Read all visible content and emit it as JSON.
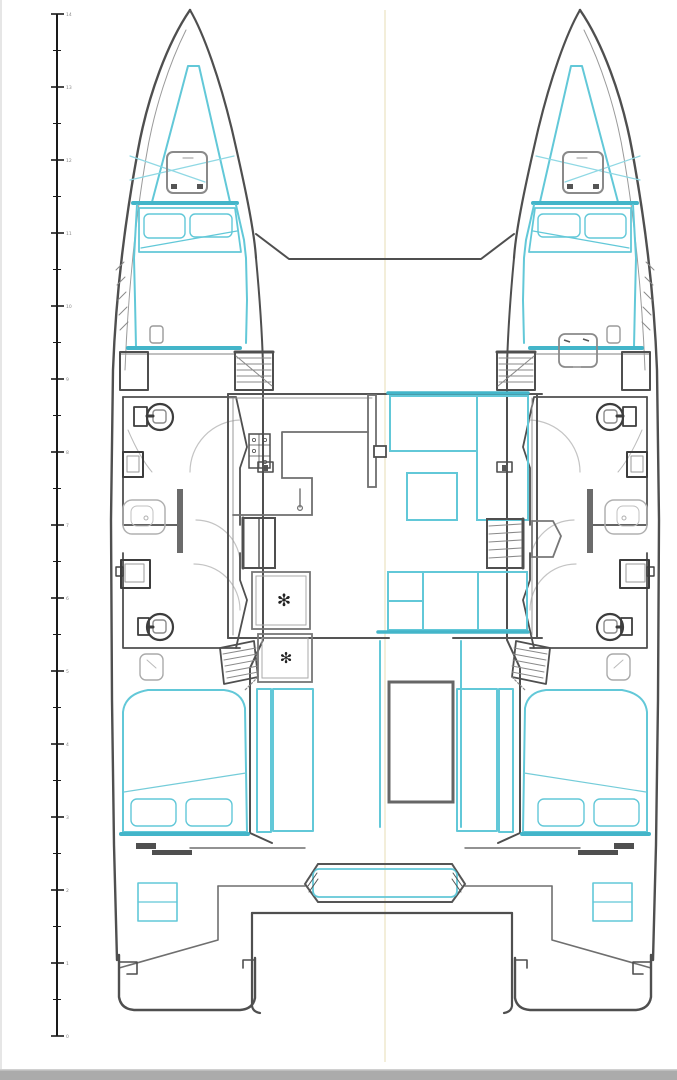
{
  "drawing": {
    "kind": "catamaran-deck-layout-plan"
  },
  "ruler": {
    "labels": [
      "14",
      "13",
      "12",
      "11",
      "10",
      "9",
      "8",
      "7",
      "6",
      "5",
      "4",
      "3",
      "2",
      "1",
      "0"
    ]
  },
  "symbols": {
    "freezer": "✻"
  },
  "colors": {
    "hull_outline": "#4f4f4f",
    "furniture_grey": "#9a9a9a",
    "light_grey": "#c4c4c4",
    "accent_cyan": "#62c8d8",
    "accent_cyan_strong": "#43b5c9",
    "centerline_cream": "#f3eeda",
    "ruler_black": "#1a1a1a",
    "label_grey": "#8a8a8a",
    "bottom_bar": "#ababab"
  }
}
